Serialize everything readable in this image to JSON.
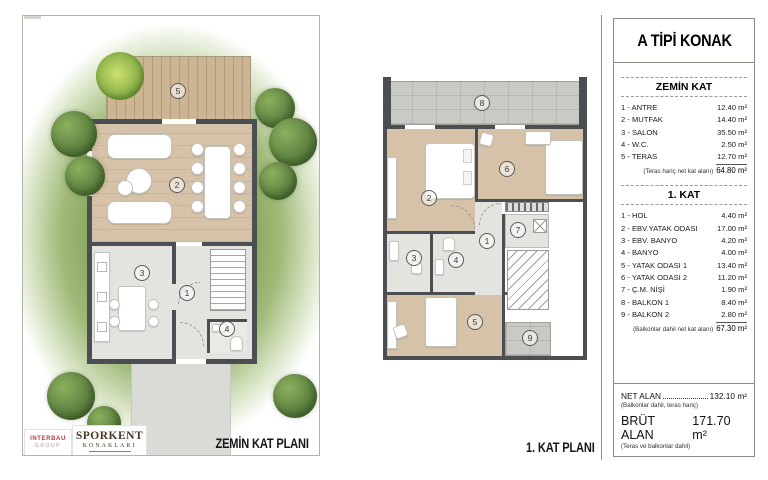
{
  "info": {
    "title": "A TİPİ KONAK",
    "sections": [
      {
        "header": "ZEMİN KAT",
        "rows": [
          {
            "label": "1 - ANTRE",
            "value": "12.40 m²"
          },
          {
            "label": "2 - MUTFAK",
            "value": "14.40 m²"
          },
          {
            "label": "3 - SALON",
            "value": "35.50 m²"
          },
          {
            "label": "4 - W.C.",
            "value": "2.50 m²"
          },
          {
            "label": "5 - TERAS",
            "value": "12.70 m²"
          }
        ],
        "subtotal_note": "(Teras hariç net kat alanı)",
        "subtotal_value": "64.80 m²"
      },
      {
        "header": "1. KAT",
        "rows": [
          {
            "label": "1 - HOL",
            "value": "4.40 m²"
          },
          {
            "label": "2 - EBV.YATAK ODASI",
            "value": "17.00 m²"
          },
          {
            "label": "3 - EBV. BANYO",
            "value": "4.20 m²"
          },
          {
            "label": "4 - BANYO",
            "value": "4.00 m²"
          },
          {
            "label": "5 - YATAK ODASI 1",
            "value": "13.40 m²"
          },
          {
            "label": "6 - YATAK ODASI 2",
            "value": "11.20 m²"
          },
          {
            "label": "7 - Ç.M. NİŞİ",
            "value": "1.90 m²"
          },
          {
            "label": "8 - BALKON 1",
            "value": "8.40 m²"
          },
          {
            "label": "9 - BALKON 2",
            "value": "2.80 m²"
          }
        ],
        "subtotal_note": "(Balkonlar dahil net kat alanı)",
        "subtotal_value": "67.30 m²"
      }
    ],
    "net": {
      "label": "NET ALAN",
      "value": "132.10 m²",
      "note": "(Balkonlar dahil, teras hariç)"
    },
    "brut": {
      "label": "BRÜT ALAN",
      "value": "171.70 m²",
      "note": "(Teras ve balkonlar dahil)"
    }
  },
  "plans": {
    "zemin": {
      "caption": "ZEMİN KAT PLANI",
      "labels": {
        "antre": "1",
        "salon": "2",
        "mutfak": "3",
        "wc": "4",
        "teras": "5"
      }
    },
    "kat1": {
      "caption": "1. KAT PLANI",
      "labels": {
        "hol": "1",
        "ebv_yatak": "2",
        "ebv_banyo": "3",
        "banyo": "4",
        "yatak1": "5",
        "yatak2": "6",
        "cm_nisi": "7",
        "balkon1": "8",
        "balkon2": "9"
      }
    }
  },
  "logos": {
    "interbau": {
      "line1": "INTERBAU",
      "line2": "GROUP"
    },
    "sporkent": {
      "line1": "SPORKENT",
      "line2": "KONAKLARI"
    }
  },
  "colors": {
    "wall": "#4b4f52",
    "wood_floor": "#d5c2a8",
    "tile_floor": "#e3e3e0",
    "balcony": "#c9c9c6",
    "garden_green": "#7d9e52",
    "logo_red": "#b23b3f",
    "logo_brown": "#4a3826"
  }
}
